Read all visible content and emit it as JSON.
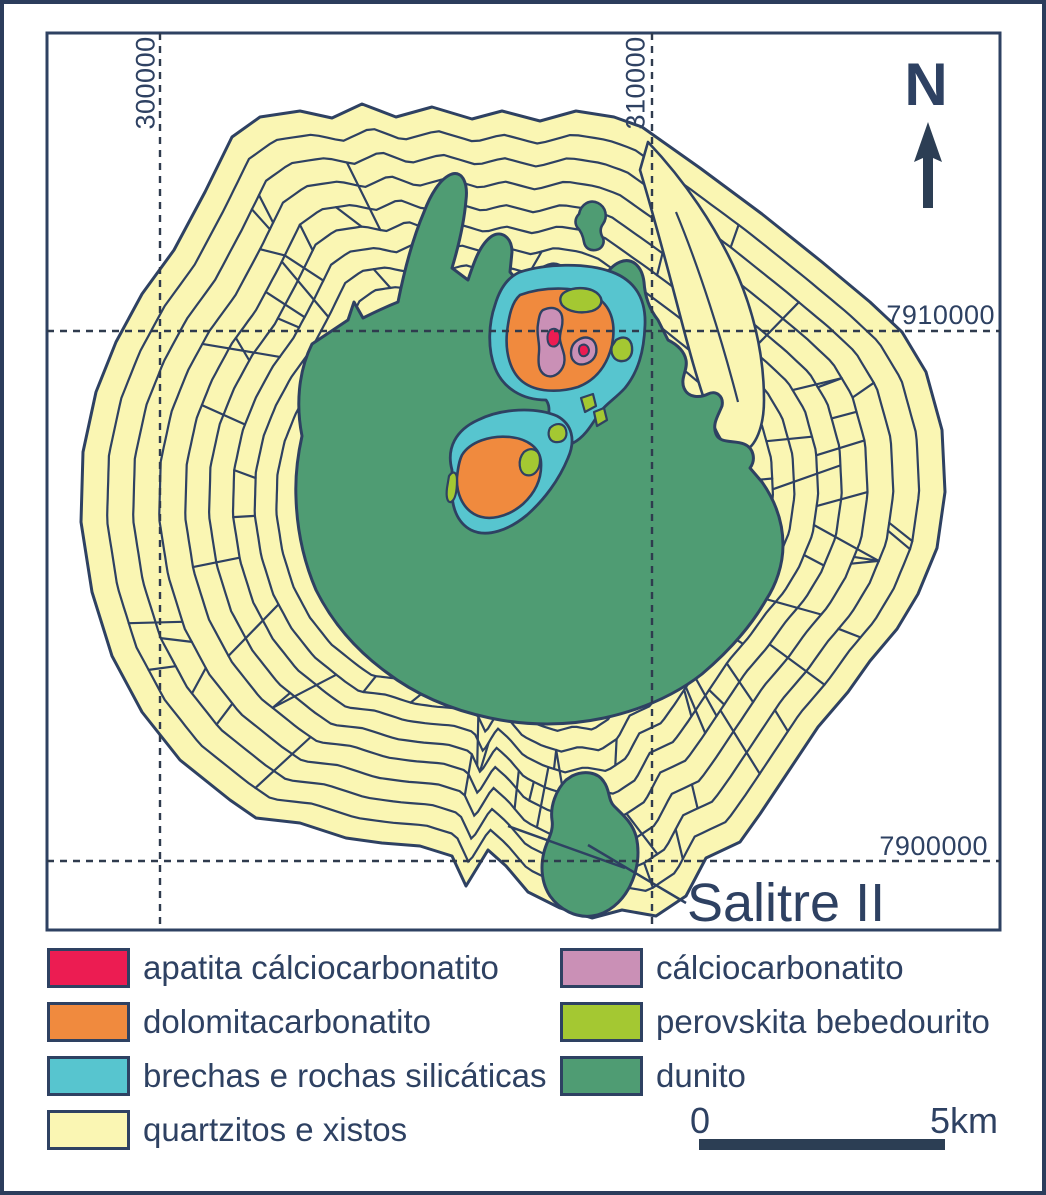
{
  "figure": {
    "north_label": "N",
    "annotation_label": "Salitre II",
    "grid_labels": {
      "x": [
        "300000",
        "310000"
      ],
      "y": [
        "7910000",
        "7900000"
      ]
    }
  },
  "legend": {
    "left": [
      {
        "label": "apatita cálciocarbonatito",
        "color": "#EC1C52"
      },
      {
        "label": "dolomitacarbonatito",
        "color": "#F08A3E"
      },
      {
        "label": "brechas e rochas silicáticas",
        "color": "#57C5CF"
      },
      {
        "label": "quartzitos e xistos",
        "color": "#FAF6B3"
      }
    ],
    "right": [
      {
        "label": "cálciocarbonatito",
        "color": "#CA90B6"
      },
      {
        "label": "perovskita bebedourito",
        "color": "#A4C832"
      },
      {
        "label": "dunito",
        "color": "#4F9C73"
      }
    ]
  },
  "scalebar": {
    "start": "0",
    "end": "5km"
  },
  "colors": {
    "outline": "#2E4162",
    "grid": "#2F3B4E",
    "frame": "#2C3D5C",
    "background": "#FFFFFF"
  }
}
